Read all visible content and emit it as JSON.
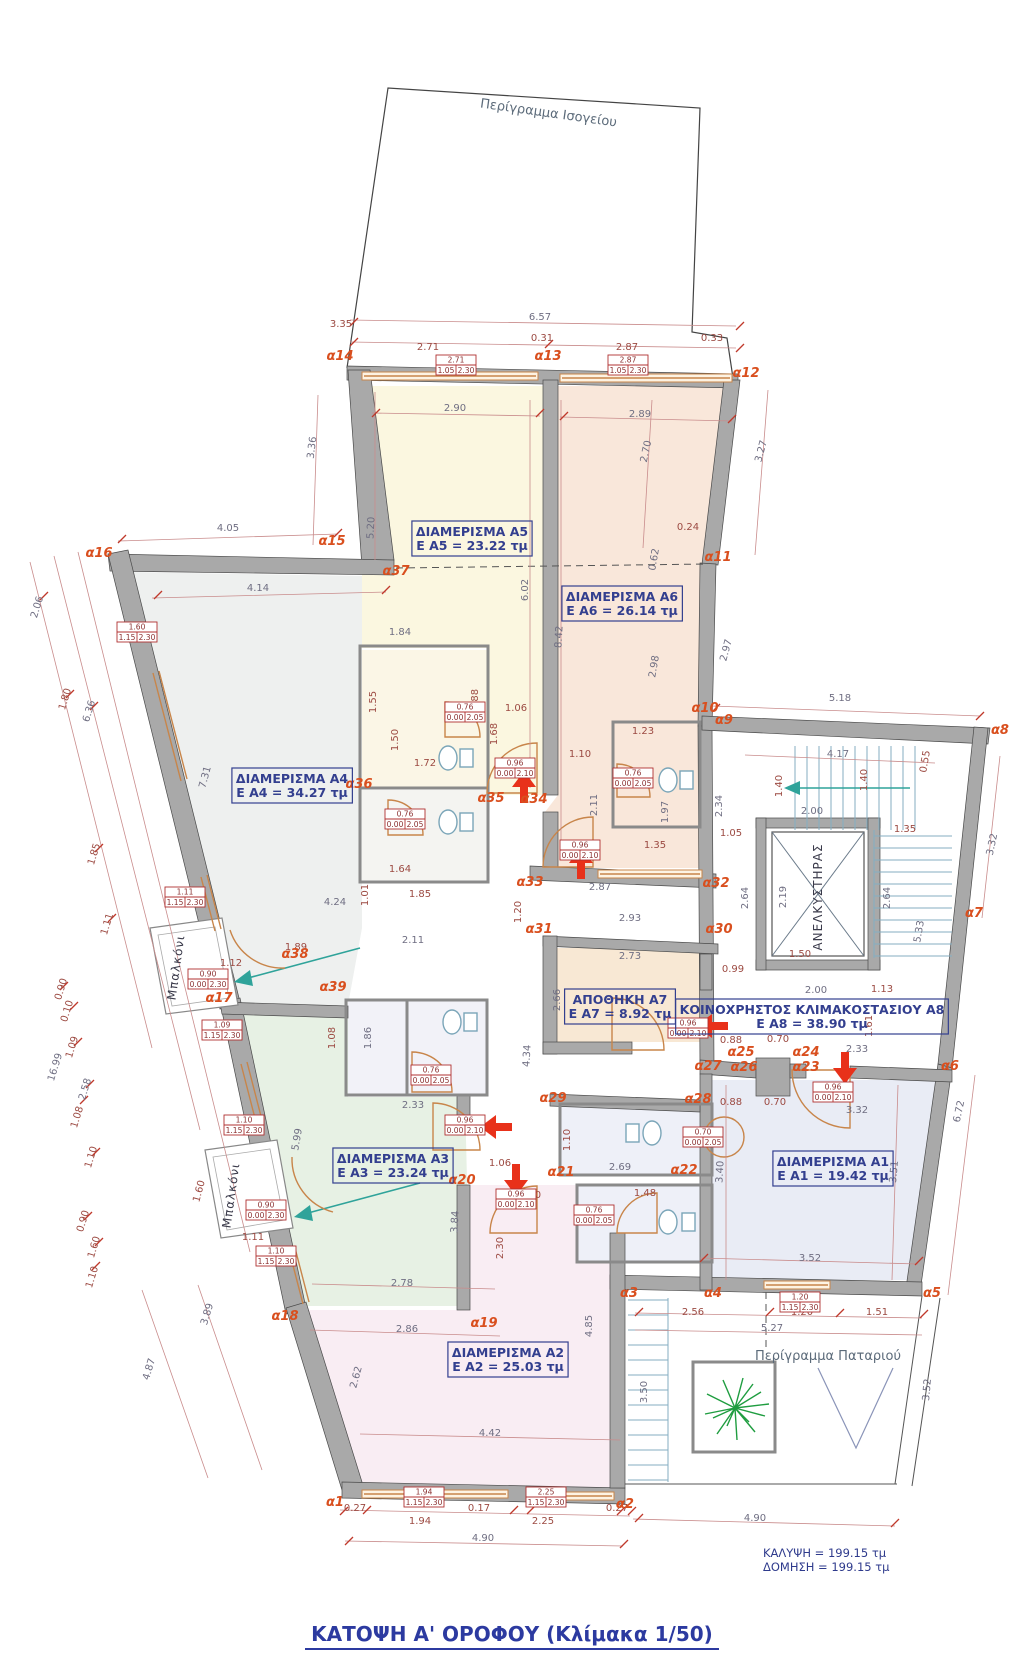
{
  "meta": {
    "title": "ΚΑΤΟΨΗ  Α' ΟΡΟΦΟΥ (Κλίμακα 1/50)",
    "coverage": "ΚΑΛΥΨΗ = 199.15 τμ",
    "construction": "ΔΟΜΗΣΗ = 199.15 τμ"
  },
  "colors": {
    "wall": "#a9a9a9",
    "window": "#c8854a",
    "dim_red": "#9c4a42",
    "dim_gray": "#6f6e82",
    "alpha": "#d94f1e",
    "room_label": "#333f8f",
    "teal": "#2fa39a",
    "red_arrow": "#e8311a",
    "plant": "#1f9d40",
    "title": "#2c3aa0"
  },
  "rooms": [
    {
      "id": "A5",
      "line1": "ΔΙΑΜΕΡΙΣΜΑ  Α5",
      "line2": "E A5 = 23.22 τμ",
      "x": 472,
      "y": 540
    },
    {
      "id": "A6",
      "line1": "ΔΙΑΜΕΡΙΣΜΑ  Α6",
      "line2": "E A6 = 26.14 τμ",
      "x": 622,
      "y": 605
    },
    {
      "id": "A4",
      "line1": "ΔΙΑΜΕΡΙΣΜΑ  Α4",
      "line2": "E A4 = 34.27 τμ",
      "x": 292,
      "y": 787
    },
    {
      "id": "A3",
      "line1": "ΔΙΑΜΕΡΙΣΜΑ  Α3",
      "line2": "E A3 = 23.24 τμ",
      "x": 393,
      "y": 1167
    },
    {
      "id": "A1",
      "line1": "ΔΙΑΜΕΡΙΣΜΑ  Α1",
      "line2": "E A1 = 19.42 τμ",
      "x": 833,
      "y": 1170
    },
    {
      "id": "A2",
      "line1": "ΔΙΑΜΕΡΙΣΜΑ  Α2",
      "line2": "E A2 = 25.03 τμ",
      "x": 508,
      "y": 1361
    },
    {
      "id": "A7",
      "line1": "ΑΠΟΘΗΚΗ  Α7",
      "line2": "E A7 = 8.92 τμ",
      "x": 620,
      "y": 1008
    },
    {
      "id": "A8",
      "line1": "ΚΟΙΝΟΧΡΗΣΤΟΣ ΚΛΙΜΑΚΟΣΤΑΣΙΟΥ Α8",
      "line2": "E A8 = 38.90 τμ",
      "x": 812,
      "y": 1018
    }
  ],
  "vertical_labels": [
    {
      "t": "ΑΝΕΛΚΥΣΤΗΡΑΣ",
      "x": 822,
      "y": 897,
      "r": -90
    },
    {
      "t": "Μπαλκόνι",
      "x": 180,
      "y": 968,
      "r": -82
    },
    {
      "t": "Μπαλκόνι",
      "x": 235,
      "y": 1196,
      "r": -82
    }
  ],
  "free_labels": [
    {
      "t": "Περίγραμμα Ισογείου",
      "x": 548,
      "y": 117,
      "r": 8
    },
    {
      "t": "Περίγραμμα Παταριού",
      "x": 828,
      "y": 1360,
      "r": 0
    }
  ],
  "alpha_points": [
    {
      "t": "α1",
      "x": 335,
      "y": 1506
    },
    {
      "t": "α2",
      "x": 625,
      "y": 1508
    },
    {
      "t": "α3",
      "x": 629,
      "y": 1297
    },
    {
      "t": "α4",
      "x": 713,
      "y": 1297
    },
    {
      "t": "α5",
      "x": 932,
      "y": 1297
    },
    {
      "t": "α6",
      "x": 950,
      "y": 1070
    },
    {
      "t": "α7",
      "x": 974,
      "y": 917
    },
    {
      "t": "α8",
      "x": 1000,
      "y": 734
    },
    {
      "t": "α9",
      "x": 724,
      "y": 724
    },
    {
      "t": "α10",
      "x": 705,
      "y": 712
    },
    {
      "t": "α11",
      "x": 718,
      "y": 561
    },
    {
      "t": "α12",
      "x": 746,
      "y": 377
    },
    {
      "t": "α13",
      "x": 548,
      "y": 360
    },
    {
      "t": "α14",
      "x": 340,
      "y": 360
    },
    {
      "t": "α15",
      "x": 332,
      "y": 545
    },
    {
      "t": "α16",
      "x": 99,
      "y": 557
    },
    {
      "t": "α17",
      "x": 219,
      "y": 1002
    },
    {
      "t": "α18",
      "x": 285,
      "y": 1320
    },
    {
      "t": "α19",
      "x": 484,
      "y": 1327
    },
    {
      "t": "α20",
      "x": 462,
      "y": 1184
    },
    {
      "t": "α21",
      "x": 561,
      "y": 1176
    },
    {
      "t": "α22",
      "x": 684,
      "y": 1174
    },
    {
      "t": "α23",
      "x": 806,
      "y": 1071
    },
    {
      "t": "α24",
      "x": 806,
      "y": 1056
    },
    {
      "t": "α25",
      "x": 741,
      "y": 1056
    },
    {
      "t": "α26",
      "x": 744,
      "y": 1071
    },
    {
      "t": "α27",
      "x": 708,
      "y": 1070
    },
    {
      "t": "α28",
      "x": 698,
      "y": 1103
    },
    {
      "t": "α29",
      "x": 553,
      "y": 1102
    },
    {
      "t": "α30",
      "x": 719,
      "y": 933
    },
    {
      "t": "α31",
      "x": 539,
      "y": 933
    },
    {
      "t": "α32",
      "x": 716,
      "y": 887
    },
    {
      "t": "α33",
      "x": 530,
      "y": 886
    },
    {
      "t": "α34",
      "x": 534,
      "y": 803
    },
    {
      "t": "α35",
      "x": 491,
      "y": 802
    },
    {
      "t": "α36",
      "x": 359,
      "y": 788
    },
    {
      "t": "α37",
      "x": 396,
      "y": 575
    },
    {
      "t": "α38",
      "x": 295,
      "y": 958
    },
    {
      "t": "α39",
      "x": 333,
      "y": 991
    }
  ],
  "dimensions": [
    {
      "t": "6.57",
      "x": 540,
      "y": 320,
      "g": 1
    },
    {
      "t": "0.31",
      "x": 542,
      "y": 341
    },
    {
      "t": "2.71",
      "x": 428,
      "y": 350
    },
    {
      "t": "2.87",
      "x": 627,
      "y": 350
    },
    {
      "t": "3.35",
      "x": 341,
      "y": 327
    },
    {
      "t": "0.33",
      "x": 712,
      "y": 341
    },
    {
      "t": "2.90",
      "x": 455,
      "y": 411,
      "g": 1
    },
    {
      "t": "2.89",
      "x": 640,
      "y": 417,
      "g": 1
    },
    {
      "t": "3.36",
      "x": 315,
      "y": 448,
      "r": -83,
      "g": 1
    },
    {
      "t": "2.70",
      "x": 649,
      "y": 452,
      "r": -78,
      "g": 1
    },
    {
      "t": "3.27",
      "x": 764,
      "y": 452,
      "r": -75,
      "g": 1
    },
    {
      "t": "0.24",
      "x": 688,
      "y": 530
    },
    {
      "t": "0.62",
      "x": 657,
      "y": 560,
      "r": -80,
      "g": 1
    },
    {
      "t": "4.05",
      "x": 228,
      "y": 531,
      "g": 1
    },
    {
      "t": "4.14",
      "x": 258,
      "y": 591,
      "g": 1
    },
    {
      "t": "5.20",
      "x": 374,
      "y": 528,
      "r": -87,
      "g": 1
    },
    {
      "t": "6.02",
      "x": 528,
      "y": 590,
      "r": -90,
      "g": 1
    },
    {
      "t": "8.42",
      "x": 562,
      "y": 637,
      "r": -87,
      "g": 1
    },
    {
      "t": "2.98",
      "x": 657,
      "y": 667,
      "r": -80,
      "g": 1
    },
    {
      "t": "2.97",
      "x": 729,
      "y": 651,
      "r": -75,
      "g": 1
    },
    {
      "t": "2.06",
      "x": 40,
      "y": 608,
      "r": -73,
      "g": 1
    },
    {
      "t": "1.80",
      "x": 68,
      "y": 700,
      "r": -73
    },
    {
      "t": "6.36",
      "x": 92,
      "y": 712,
      "r": -73,
      "g": 1
    },
    {
      "t": "1.85",
      "x": 97,
      "y": 855,
      "r": -73
    },
    {
      "t": "1.11",
      "x": 110,
      "y": 925,
      "r": -73
    },
    {
      "t": "16.99",
      "x": 58,
      "y": 1068,
      "r": -73,
      "g": 1
    },
    {
      "t": "0.90",
      "x": 64,
      "y": 990,
      "r": -73
    },
    {
      "t": "0.10",
      "x": 70,
      "y": 1012,
      "r": -73
    },
    {
      "t": "1.09",
      "x": 75,
      "y": 1048,
      "r": -73
    },
    {
      "t": "2.58",
      "x": 88,
      "y": 1090,
      "r": -73,
      "g": 1
    },
    {
      "t": "1.08",
      "x": 80,
      "y": 1118,
      "r": -73
    },
    {
      "t": "1.10",
      "x": 94,
      "y": 1158,
      "r": -73
    },
    {
      "t": "0.90",
      "x": 86,
      "y": 1222,
      "r": -73
    },
    {
      "t": "1.60",
      "x": 97,
      "y": 1248,
      "r": -73
    },
    {
      "t": "1.10",
      "x": 95,
      "y": 1278,
      "r": -73
    },
    {
      "t": "3.89",
      "x": 210,
      "y": 1315,
      "r": -73,
      "g": 1
    },
    {
      "t": "4.87",
      "x": 152,
      "y": 1370,
      "r": -73,
      "g": 1
    },
    {
      "t": "7.31",
      "x": 208,
      "y": 778,
      "r": -75,
      "g": 1
    },
    {
      "t": "1.84",
      "x": 400,
      "y": 635,
      "g": 1
    },
    {
      "t": "1.55",
      "x": 376,
      "y": 702,
      "r": -90
    },
    {
      "t": "1.50",
      "x": 398,
      "y": 740,
      "r": -90
    },
    {
      "t": "1.72",
      "x": 425,
      "y": 766
    },
    {
      "t": "1.88",
      "x": 478,
      "y": 700,
      "r": -90
    },
    {
      "t": "1.06",
      "x": 516,
      "y": 711
    },
    {
      "t": "1.68",
      "x": 497,
      "y": 734,
      "r": -90
    },
    {
      "t": "1.10",
      "x": 580,
      "y": 757
    },
    {
      "t": "1.23",
      "x": 643,
      "y": 734
    },
    {
      "t": "2.11",
      "x": 597,
      "y": 805,
      "r": -90,
      "g": 1
    },
    {
      "t": "1.97",
      "x": 668,
      "y": 812,
      "r": -90,
      "g": 1
    },
    {
      "t": "1.35",
      "x": 655,
      "y": 848
    },
    {
      "t": "2.34",
      "x": 722,
      "y": 806,
      "r": -90,
      "g": 1
    },
    {
      "t": "1.05",
      "x": 731,
      "y": 836
    },
    {
      "t": "1.40",
      "x": 782,
      "y": 786,
      "r": -90
    },
    {
      "t": "1.40",
      "x": 867,
      "y": 780,
      "r": -90
    },
    {
      "t": "1.64",
      "x": 400,
      "y": 872
    },
    {
      "t": "1.85",
      "x": 420,
      "y": 897
    },
    {
      "t": "4.24",
      "x": 335,
      "y": 905,
      "g": 1
    },
    {
      "t": "1.01",
      "x": 368,
      "y": 895,
      "r": -90
    },
    {
      "t": "2.87",
      "x": 600,
      "y": 890,
      "g": 1
    },
    {
      "t": "1.20",
      "x": 521,
      "y": 912,
      "r": -90
    },
    {
      "t": "2.93",
      "x": 630,
      "y": 921,
      "g": 1
    },
    {
      "t": "2.73",
      "x": 630,
      "y": 959,
      "g": 1
    },
    {
      "t": "2.64",
      "x": 748,
      "y": 898,
      "r": -90,
      "g": 1
    },
    {
      "t": "2.19",
      "x": 786,
      "y": 897,
      "r": -90,
      "g": 1
    },
    {
      "t": "0.99",
      "x": 733,
      "y": 972
    },
    {
      "t": "2.00",
      "x": 816,
      "y": 993,
      "g": 1
    },
    {
      "t": "2.66",
      "x": 560,
      "y": 1000,
      "r": -90,
      "g": 1
    },
    {
      "t": "4.34",
      "x": 530,
      "y": 1056,
      "r": -87,
      "g": 1
    },
    {
      "t": "5.18",
      "x": 840,
      "y": 701,
      "g": 1
    },
    {
      "t": "4.17",
      "x": 838,
      "y": 757,
      "g": 1
    },
    {
      "t": "0.55",
      "x": 928,
      "y": 762,
      "r": -80
    },
    {
      "t": "2.00",
      "x": 812,
      "y": 814,
      "g": 1
    },
    {
      "t": "1.35",
      "x": 905,
      "y": 832
    },
    {
      "t": "2.64",
      "x": 890,
      "y": 898,
      "r": -90,
      "g": 1
    },
    {
      "t": "5.33",
      "x": 922,
      "y": 932,
      "r": -80,
      "g": 1
    },
    {
      "t": "3.32",
      "x": 995,
      "y": 845,
      "r": -78,
      "g": 1
    },
    {
      "t": "1.50",
      "x": 800,
      "y": 957
    },
    {
      "t": "1.13",
      "x": 882,
      "y": 992
    },
    {
      "t": "1.61",
      "x": 872,
      "y": 1026,
      "r": -90
    },
    {
      "t": "0.88",
      "x": 731,
      "y": 1043
    },
    {
      "t": "0.70",
      "x": 778,
      "y": 1042
    },
    {
      "t": "0.88",
      "x": 731,
      "y": 1105
    },
    {
      "t": "0.70",
      "x": 775,
      "y": 1105
    },
    {
      "t": "2.33",
      "x": 857,
      "y": 1052,
      "g": 1
    },
    {
      "t": "3.32",
      "x": 857,
      "y": 1113,
      "g": 1
    },
    {
      "t": "3.40",
      "x": 723,
      "y": 1172,
      "r": -87,
      "g": 1
    },
    {
      "t": "3.51",
      "x": 897,
      "y": 1172,
      "r": -85,
      "g": 1
    },
    {
      "t": "3.52",
      "x": 810,
      "y": 1261,
      "g": 1
    },
    {
      "t": "6.72",
      "x": 962,
      "y": 1112,
      "r": -78,
      "g": 1
    },
    {
      "t": "3.52",
      "x": 930,
      "y": 1390,
      "r": -85,
      "g": 1
    },
    {
      "t": "1.89",
      "x": 296,
      "y": 950
    },
    {
      "t": "2.11",
      "x": 413,
      "y": 943,
      "g": 1
    },
    {
      "t": "1.08",
      "x": 335,
      "y": 1038,
      "r": -90
    },
    {
      "t": "1.86",
      "x": 371,
      "y": 1038,
      "r": -90,
      "g": 1
    },
    {
      "t": "2.33",
      "x": 413,
      "y": 1108,
      "g": 1
    },
    {
      "t": "5.99",
      "x": 300,
      "y": 1140,
      "r": -80,
      "g": 1
    },
    {
      "t": "1.12",
      "x": 231,
      "y": 966
    },
    {
      "t": "1.11",
      "x": 253,
      "y": 1240
    },
    {
      "t": "1.60",
      "x": 202,
      "y": 1192,
      "r": -75
    },
    {
      "t": "3.84",
      "x": 458,
      "y": 1222,
      "r": -87,
      "g": 1
    },
    {
      "t": "1.06",
      "x": 500,
      "y": 1166
    },
    {
      "t": "2.20",
      "x": 530,
      "y": 1198
    },
    {
      "t": "2.30",
      "x": 503,
      "y": 1248,
      "r": -90
    },
    {
      "t": "2.69",
      "x": 620,
      "y": 1170,
      "g": 1
    },
    {
      "t": "1.10",
      "x": 570,
      "y": 1140,
      "r": -90
    },
    {
      "t": "1.48",
      "x": 645,
      "y": 1196
    },
    {
      "t": "2.78",
      "x": 402,
      "y": 1286,
      "g": 1
    },
    {
      "t": "2.86",
      "x": 407,
      "y": 1332,
      "g": 1
    },
    {
      "t": "2.62",
      "x": 359,
      "y": 1378,
      "r": -75,
      "g": 1
    },
    {
      "t": "4.42",
      "x": 490,
      "y": 1436,
      "g": 1
    },
    {
      "t": "4.85",
      "x": 592,
      "y": 1326,
      "r": -90,
      "g": 1
    },
    {
      "t": "3.50",
      "x": 647,
      "y": 1392,
      "r": -90,
      "g": 1
    },
    {
      "t": "0.27",
      "x": 355,
      "y": 1511
    },
    {
      "t": "1.94",
      "x": 420,
      "y": 1524
    },
    {
      "t": "0.17",
      "x": 479,
      "y": 1511
    },
    {
      "t": "2.25",
      "x": 543,
      "y": 1524
    },
    {
      "t": "0.27",
      "x": 617,
      "y": 1511
    },
    {
      "t": "4.90",
      "x": 483,
      "y": 1541,
      "g": 1
    },
    {
      "t": "4.90",
      "x": 755,
      "y": 1521,
      "g": 1
    },
    {
      "t": "2.56",
      "x": 693,
      "y": 1315
    },
    {
      "t": "1.20",
      "x": 802,
      "y": 1315
    },
    {
      "t": "1.51",
      "x": 877,
      "y": 1315
    },
    {
      "t": "5.27",
      "x": 772,
      "y": 1331,
      "g": 1
    }
  ],
  "spec_boxes": [
    {
      "top": "2.71",
      "bl": "1.05",
      "br": "2.30",
      "x": 456,
      "y": 365
    },
    {
      "top": "2.87",
      "bl": "1.05",
      "br": "2.30",
      "x": 628,
      "y": 365
    },
    {
      "top": "1.60",
      "bl": "1.15",
      "br": "2.30",
      "x": 137,
      "y": 632
    },
    {
      "top": "1.11",
      "bl": "1.15",
      "br": "2.30",
      "x": 185,
      "y": 897
    },
    {
      "top": "0.90",
      "bl": "0.00",
      "br": "2.30",
      "x": 208,
      "y": 979
    },
    {
      "top": "1.09",
      "bl": "1.15",
      "br": "2.30",
      "x": 222,
      "y": 1030
    },
    {
      "top": "1.10",
      "bl": "1.15",
      "br": "2.30",
      "x": 244,
      "y": 1125
    },
    {
      "top": "0.90",
      "bl": "0.00",
      "br": "2.30",
      "x": 266,
      "y": 1210
    },
    {
      "top": "1.10",
      "bl": "1.15",
      "br": "2.30",
      "x": 276,
      "y": 1256
    },
    {
      "top": "0.96",
      "bl": "0.00",
      "br": "2.10",
      "x": 515,
      "y": 768
    },
    {
      "top": "0.96",
      "bl": "0.00",
      "br": "2.10",
      "x": 580,
      "y": 850
    },
    {
      "top": "0.76",
      "bl": "0.00",
      "br": "2.05",
      "x": 465,
      "y": 712
    },
    {
      "top": "0.76",
      "bl": "0.00",
      "br": "2.05",
      "x": 405,
      "y": 819
    },
    {
      "top": "0.76",
      "bl": "0.00",
      "br": "2.05",
      "x": 633,
      "y": 778
    },
    {
      "top": "0.76",
      "bl": "0.00",
      "br": "2.05",
      "x": 431,
      "y": 1075
    },
    {
      "top": "0.76",
      "bl": "0.00",
      "br": "2.05",
      "x": 594,
      "y": 1215
    },
    {
      "top": "0.70",
      "bl": "0.00",
      "br": "2.05",
      "x": 703,
      "y": 1137
    },
    {
      "top": "0.96",
      "bl": "0.00",
      "br": "2.10",
      "x": 688,
      "y": 1028
    },
    {
      "top": "0.96",
      "bl": "0.00",
      "br": "2.10",
      "x": 833,
      "y": 1092
    },
    {
      "top": "0.96",
      "bl": "0.00",
      "br": "2.10",
      "x": 516,
      "y": 1199
    },
    {
      "top": "0.96",
      "bl": "0.00",
      "br": "2.10",
      "x": 465,
      "y": 1125
    },
    {
      "top": "1.20",
      "bl": "1.15",
      "br": "2.30",
      "x": 800,
      "y": 1302
    },
    {
      "top": "1.94",
      "bl": "1.15",
      "br": "2.30",
      "x": 424,
      "y": 1497
    },
    {
      "top": "2.25",
      "bl": "1.15",
      "br": "2.30",
      "x": 546,
      "y": 1497
    }
  ]
}
